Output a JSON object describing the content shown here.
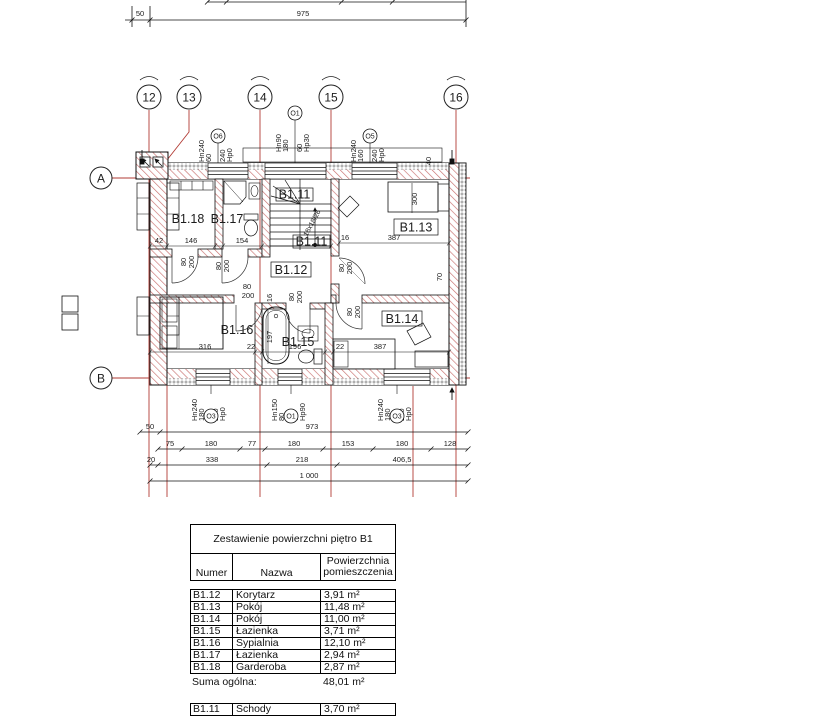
{
  "plan": {
    "axes_v": [
      "12",
      "13",
      "14",
      "15",
      "16"
    ],
    "axes_h": [
      "A",
      "B"
    ],
    "dim_top": {
      "a": "50",
      "b": "975"
    },
    "dim_bottom": {
      "r1a": "50",
      "r1b": "973",
      "r2": [
        "75",
        "180",
        "77",
        "180",
        "153",
        "180",
        "128"
      ],
      "r3": [
        "20",
        "338",
        "218",
        "406,5"
      ],
      "r4": "1 000"
    },
    "openings_top": [
      {
        "sym": "O6",
        "l1": "Hn240",
        "l2": "60",
        "l3": "240",
        "l4": "Hp0"
      },
      {
        "sym": "O1",
        "l1": "Hn90",
        "l2": "180",
        "l3": "60",
        "l4": "Hp30"
      },
      {
        "sym": "O5",
        "l1": "Hn240",
        "l2": "160",
        "l3": "240",
        "l4": "Hp0"
      }
    ],
    "openings_bottom": [
      {
        "sym": "O3",
        "l1": "Hn240",
        "l2": "180",
        "l3": "240",
        "l4": "Hp0"
      },
      {
        "sym": "O1",
        "l1": "Hn150",
        "l2": "80",
        "l3": "60",
        "l4": "Hp90"
      },
      {
        "sym": "O3",
        "l1": "Hn240",
        "l2": "180",
        "l3": "240",
        "l4": "Hp0"
      }
    ],
    "rooms": {
      "b111": "B1.11",
      "b112": "B1.12",
      "b113": "B1.13",
      "b114": "B1.14",
      "b115": "B1.15",
      "b116": "B1.16",
      "b117": "B1.17",
      "b118": "B1.18"
    },
    "stair_note": "18x18/26",
    "dims": {
      "d42": "42",
      "d146": "146",
      "d154": "154",
      "d16": "16",
      "d387": "387",
      "d300": "300",
      "d40": "40",
      "d316": "316",
      "d22": "22",
      "d197": "197",
      "d196": "196",
      "d70": "70",
      "door_w": "80",
      "door_h": "200"
    }
  },
  "table": {
    "title": "Zestawienie powierzchni piętro B1",
    "headers": {
      "num": "Numer",
      "name": "Nazwa",
      "area": "Powierzchnia pomieszczenia"
    },
    "rows": [
      {
        "num": "B1.12",
        "name": "Korytarz",
        "area": "3,91 m²"
      },
      {
        "num": "B1.13",
        "name": "Pokój",
        "area": "11,48 m²"
      },
      {
        "num": "B1.14",
        "name": "Pokój",
        "area": "11,00 m²"
      },
      {
        "num": "B1.15",
        "name": "Łazienka",
        "area": "3,71 m²"
      },
      {
        "num": "B1.16",
        "name": "Sypialnia",
        "area": "12,10 m²"
      },
      {
        "num": "B1.17",
        "name": "Łazienka",
        "area": "2,94 m²"
      },
      {
        "num": "B1.18",
        "name": "Garderoba",
        "area": "2,87 m²"
      }
    ],
    "total_label": "Suma ogólna:",
    "total_value": "48,01 m²",
    "extra_row": {
      "num": "B1.11",
      "name": "Schody",
      "area": "3,70 m²"
    }
  },
  "colors": {
    "grid_red": "#b23b34",
    "hatch_red": "#c9716f",
    "line": "#111111"
  }
}
